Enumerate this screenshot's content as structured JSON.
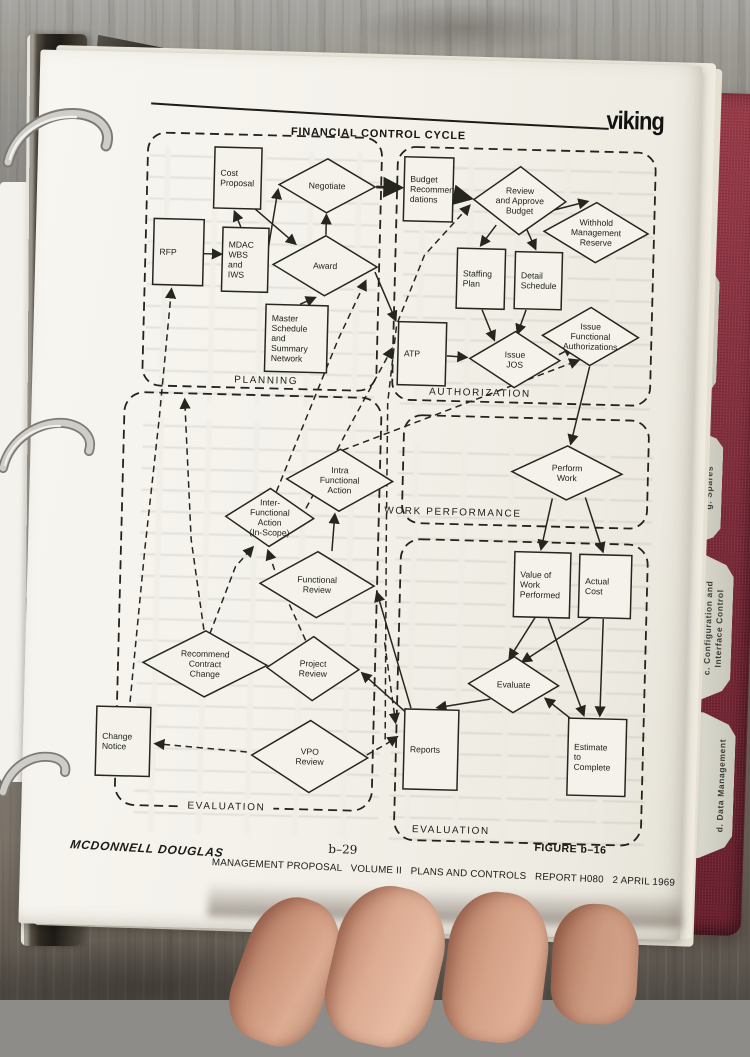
{
  "header": {
    "logo": "viking",
    "title": "FINANCIAL CONTROL CYCLE"
  },
  "flowchart": {
    "sections": [
      {
        "id": "planning",
        "label": "PLANNING"
      },
      {
        "id": "authorization",
        "label": "AUTHORIZATION"
      },
      {
        "id": "work-performance",
        "label": "WORK PERFORMANCE"
      },
      {
        "id": "evaluation-left",
        "label": "EVALUATION"
      },
      {
        "id": "evaluation-right",
        "label": "EVALUATION"
      }
    ],
    "nodes": [
      {
        "id": "cost_proposal",
        "type": "box",
        "label": "Cost\nProposal"
      },
      {
        "id": "rfp",
        "type": "box",
        "label": "RFP"
      },
      {
        "id": "mdac",
        "type": "box",
        "label": "MDAC\nWBS\nand\nIWS"
      },
      {
        "id": "master_schedule",
        "type": "box",
        "label": "Master\nSchedule\nand\nSummary\nNetwork"
      },
      {
        "id": "negotiate",
        "type": "diamond",
        "label": "Negotiate"
      },
      {
        "id": "award",
        "type": "diamond",
        "label": "Award"
      },
      {
        "id": "budget_recs",
        "type": "box",
        "label": "Budget\nRecommen-\ndations"
      },
      {
        "id": "review_approve",
        "type": "diamond",
        "label": "Review\nand Approve\nBudget"
      },
      {
        "id": "withhold",
        "type": "diamond",
        "label": "Withhold\nManagement\nReserve"
      },
      {
        "id": "staffing_plan",
        "type": "box",
        "label": "Staffing\nPlan"
      },
      {
        "id": "detail_schedule",
        "type": "box",
        "label": "Detail\nSchedule"
      },
      {
        "id": "atp",
        "type": "box",
        "label": "ATP"
      },
      {
        "id": "issue_jos",
        "type": "diamond",
        "label": "Issue\nJOS"
      },
      {
        "id": "issue_functional",
        "type": "diamond",
        "label": "Issue\nFunctional\nAuthorizations"
      },
      {
        "id": "perform_work",
        "type": "diamond",
        "label": "Perform\nWork"
      },
      {
        "id": "intra",
        "type": "diamond",
        "label": "Intra\nFunctional\nAction"
      },
      {
        "id": "inter",
        "type": "diamond",
        "label": "Inter-\nFunctional\nAction\n(In-Scope)"
      },
      {
        "id": "functional_review",
        "type": "diamond",
        "label": "Functional\nReview"
      },
      {
        "id": "project_review",
        "type": "diamond",
        "label": "Project\nReview"
      },
      {
        "id": "recommend",
        "type": "diamond",
        "label": "Recommend\nContract\nChange"
      },
      {
        "id": "vpo_review",
        "type": "diamond",
        "label": "VPO\nReview"
      },
      {
        "id": "change_notice",
        "type": "box",
        "label": "Change\nNotice"
      },
      {
        "id": "value_of_work",
        "type": "box",
        "label": "Value of\nWork\nPerformed"
      },
      {
        "id": "actual_cost",
        "type": "box",
        "label": "Actual\nCost"
      },
      {
        "id": "evaluate",
        "type": "diamond",
        "label": "Evaluate"
      },
      {
        "id": "reports",
        "type": "box",
        "label": "Reports"
      },
      {
        "id": "estimate",
        "type": "box",
        "label": "Estimate\nto\nComplete"
      }
    ]
  },
  "tabs": [
    {
      "label": "e.  Project Review Plan"
    },
    {
      "label": "f.  Logistics"
    },
    {
      "label": "g.  Spares"
    },
    {
      "label": "c.  Configuration and\nInterface Control"
    },
    {
      "label": "d.  Data Management"
    }
  ],
  "footer": {
    "company": "MCDONNELL DOUGLAS",
    "page_number": "b–29",
    "figure": "FIGURE b–16",
    "report_line": "MANAGEMENT PROPOSAL   VOLUME II   PLANS AND CONTROLS   REPORT H080   2 APRIL 1969"
  }
}
